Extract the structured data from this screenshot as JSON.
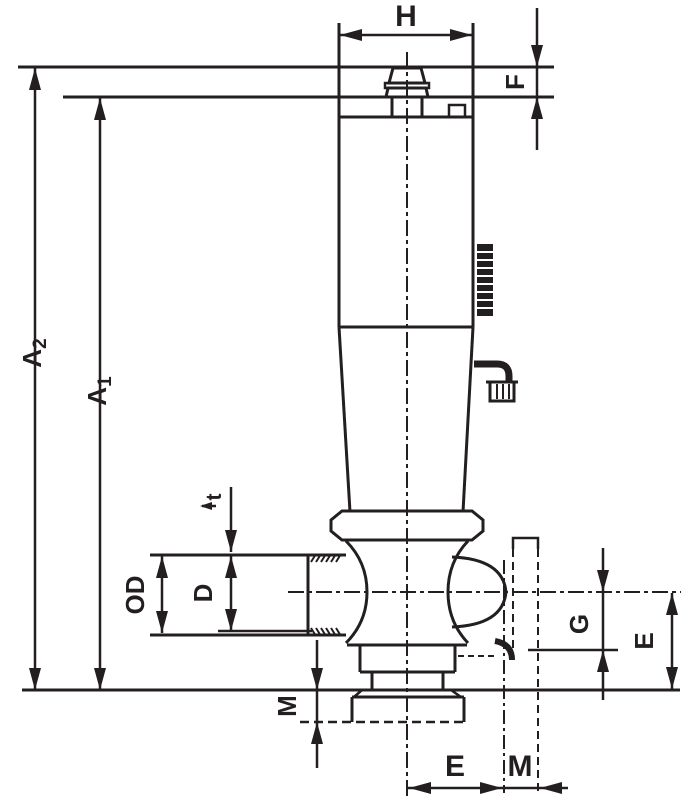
{
  "drawing": {
    "type": "technical-dimension-drawing",
    "subject": "threaded valve with handle, side elevation with dimension callouts",
    "ink_color": "#231f20",
    "background_color": "#ffffff",
    "labels": {
      "h": "H",
      "f": "F",
      "a2_main": "A",
      "a2_sub": "2",
      "a1_main": "A",
      "a1_sub": "1",
      "t": "t",
      "od": "OD",
      "d": "D",
      "g": "G",
      "e_right": "E",
      "m_left": "M",
      "e_bottom": "E",
      "m_bottom": "M"
    }
  }
}
